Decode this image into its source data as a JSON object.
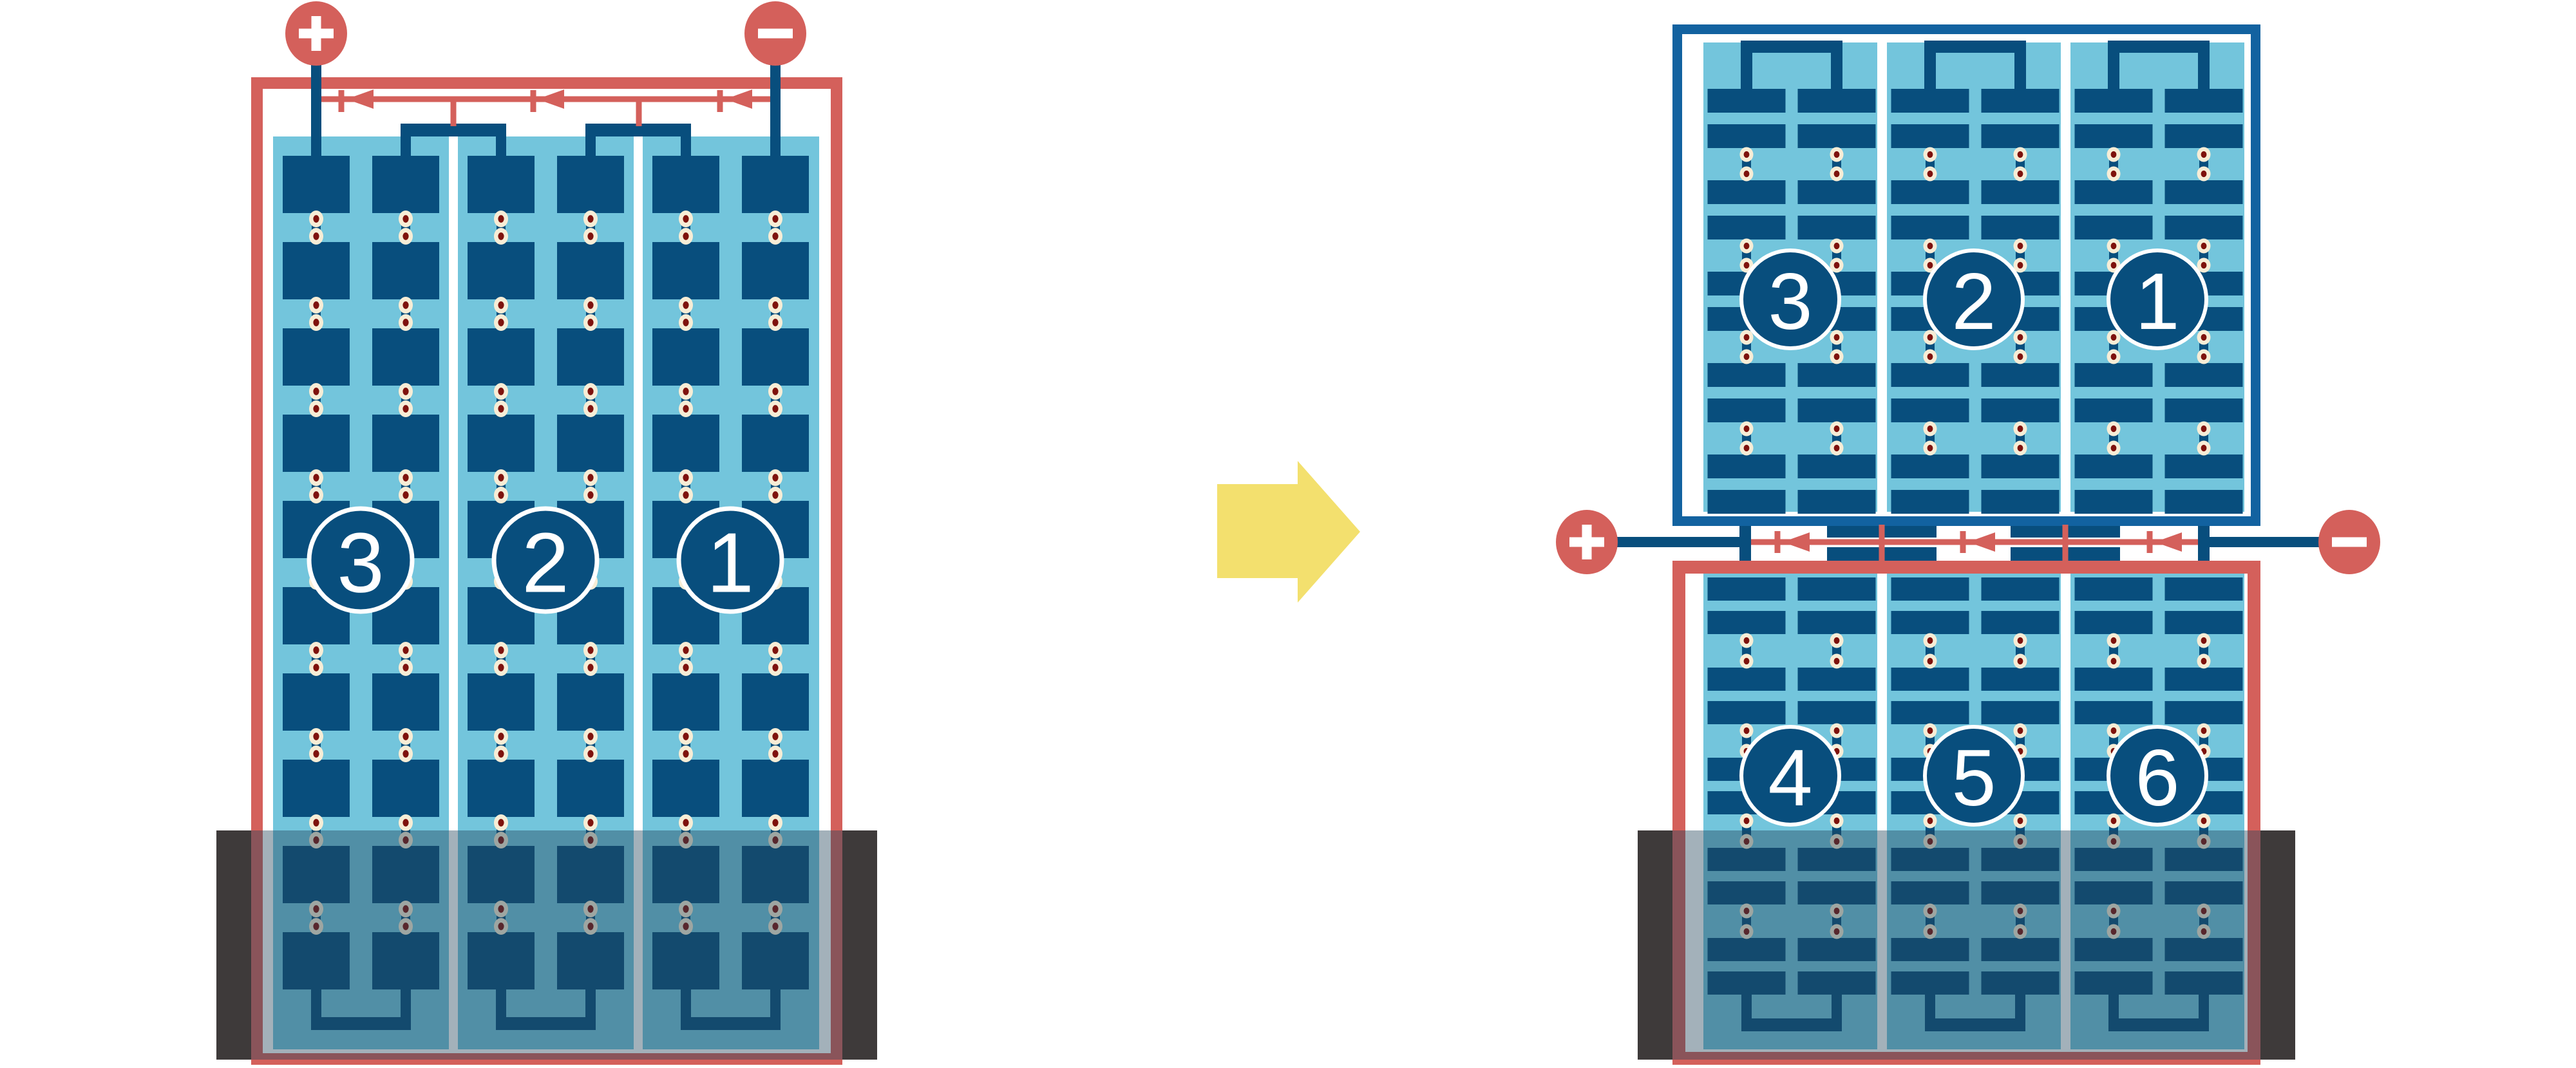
{
  "diagram_type": "solar module bypass-diode wiring comparison",
  "left_module": {
    "substring_labels": [
      "3",
      "2",
      "1"
    ],
    "positive_terminal": "+",
    "negative_terminal": "−",
    "bypass_diode_count": 3,
    "cell_columns": 6,
    "cell_rows": 10,
    "shaded_bottom": true
  },
  "right_module": {
    "top_substring_labels": [
      "3",
      "2",
      "1"
    ],
    "bottom_substring_labels": [
      "4",
      "5",
      "6"
    ],
    "positive_terminal": "+",
    "negative_terminal": "−",
    "bypass_diode_count": 3,
    "shaded_bottom": true
  },
  "transition_arrow": {
    "direction": "right"
  },
  "colors": {
    "red": "#D4605B",
    "cell_blue": "#084E7D",
    "frame_blue": "#1262A0",
    "light_blue": "#73C5DC",
    "cream": "#F7EDD6",
    "maroon": "#7E120D",
    "shade_bar_gray": "#3E3A3A",
    "shade_overlay": "rgba(35,68,90,0.42)",
    "arrow_yellow": "#F3E06E",
    "label_text": "#FFFFFF"
  }
}
